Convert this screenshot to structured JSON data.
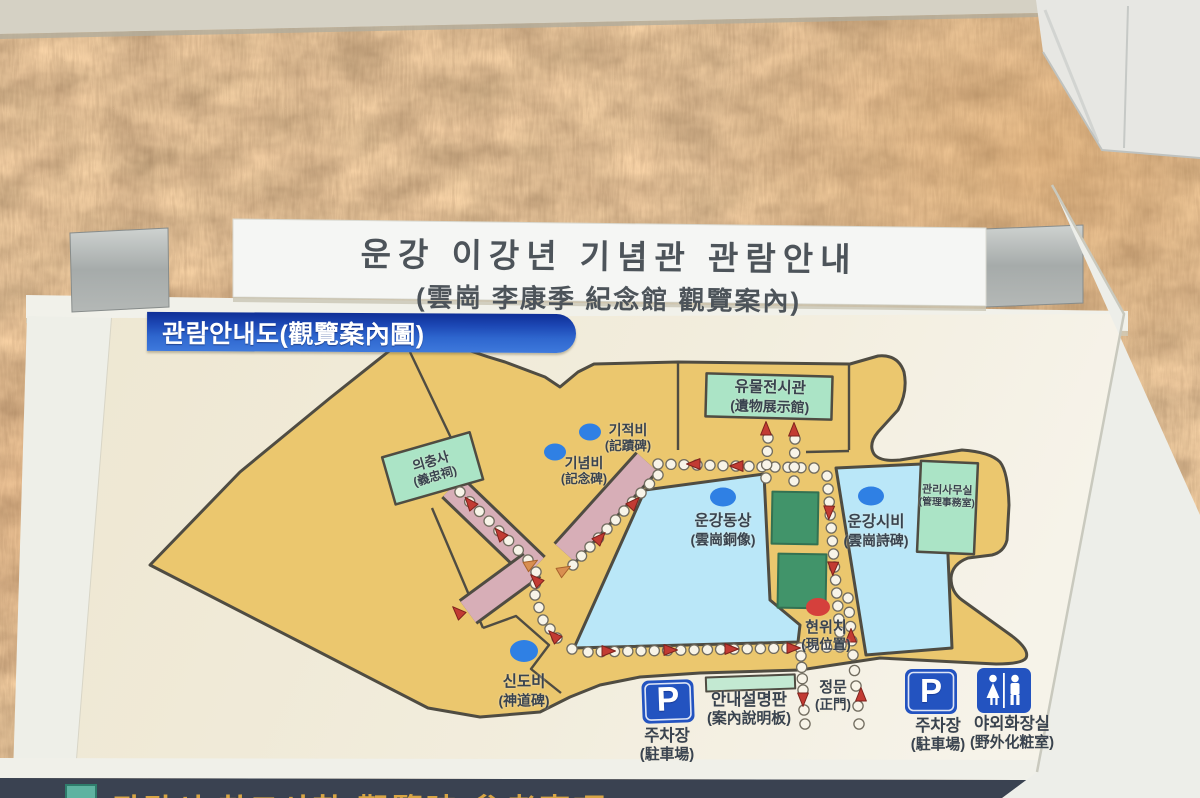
{
  "sign_header": {
    "title_ko": "운강 이강년 기념관 관람안내",
    "title_hanja": "(雲崗 李康季 紀念館 觀覽案內)"
  },
  "map_panel": {
    "banner": "관람안내도(觀覽案內圖)",
    "parking_symbol": "P",
    "labels": {
      "gijeokbi": {
        "ko": "기적비",
        "hanja": "(記蹟碑)",
        "marker": "blue-dot"
      },
      "ginyeombi": {
        "ko": "기념비",
        "hanja": "(記念碑)",
        "marker": "blue-dot"
      },
      "museum": {
        "ko": "유물전시관",
        "hanja": "(遺物展示館)",
        "marker": "green-building"
      },
      "uichungsa": {
        "ko": "의충사",
        "hanja": "(義忠祠)",
        "marker": "green-building"
      },
      "statue": {
        "ko": "운강동상",
        "hanja": "(雲崗銅像)",
        "marker": "blue-dot"
      },
      "poem_stone": {
        "ko": "운강시비",
        "hanja": "(雲崗詩碑)",
        "marker": "blue-dot"
      },
      "office": {
        "ko": "관리사무실",
        "hanja": "(管理事務室)",
        "marker": "green-building"
      },
      "current_loc": {
        "ko": "현위치",
        "hanja": "(現位置)",
        "marker": "red-dot"
      },
      "sindobi": {
        "ko": "신도비",
        "hanja": "(神道碑)",
        "marker": "blue-dot"
      },
      "gate": {
        "ko": "정문",
        "hanja": "(正門)",
        "marker": "route-arrows"
      },
      "infoboard": {
        "ko": "안내설명판",
        "hanja": "(案內說明板)",
        "marker": "green-bar"
      },
      "parking_left": {
        "ko": "주차장",
        "hanja": "(駐車場)",
        "marker": "parking-icon"
      },
      "parking_right": {
        "ko": "주차장",
        "hanja": "(駐車場)",
        "marker": "parking-icon"
      },
      "toilet": {
        "ko": "야외화장실",
        "hanja": "(野外化粧室)",
        "marker": "toilet-icon"
      }
    }
  },
  "bottom_panel": {
    "partial_title": "관람시 참고사항(觀覽時 參考事項)"
  },
  "colors": {
    "banner_blue": "#2e66ce",
    "board_cream": "#f0ecdc",
    "map_tan": "#ebc76e",
    "pond_blue": "#bae7f8",
    "building_mint": "#abe4c6",
    "lawn_dark_green": "#41946a",
    "walkway_pink": "#d7aeb7",
    "marker_blue": "#2f80e4",
    "marker_red": "#d5403c",
    "arrow_red": "#c23b33",
    "parking_blue": "#2353c0",
    "bottom_navy": "#3a4251",
    "bottom_gold": "#d8a544"
  }
}
